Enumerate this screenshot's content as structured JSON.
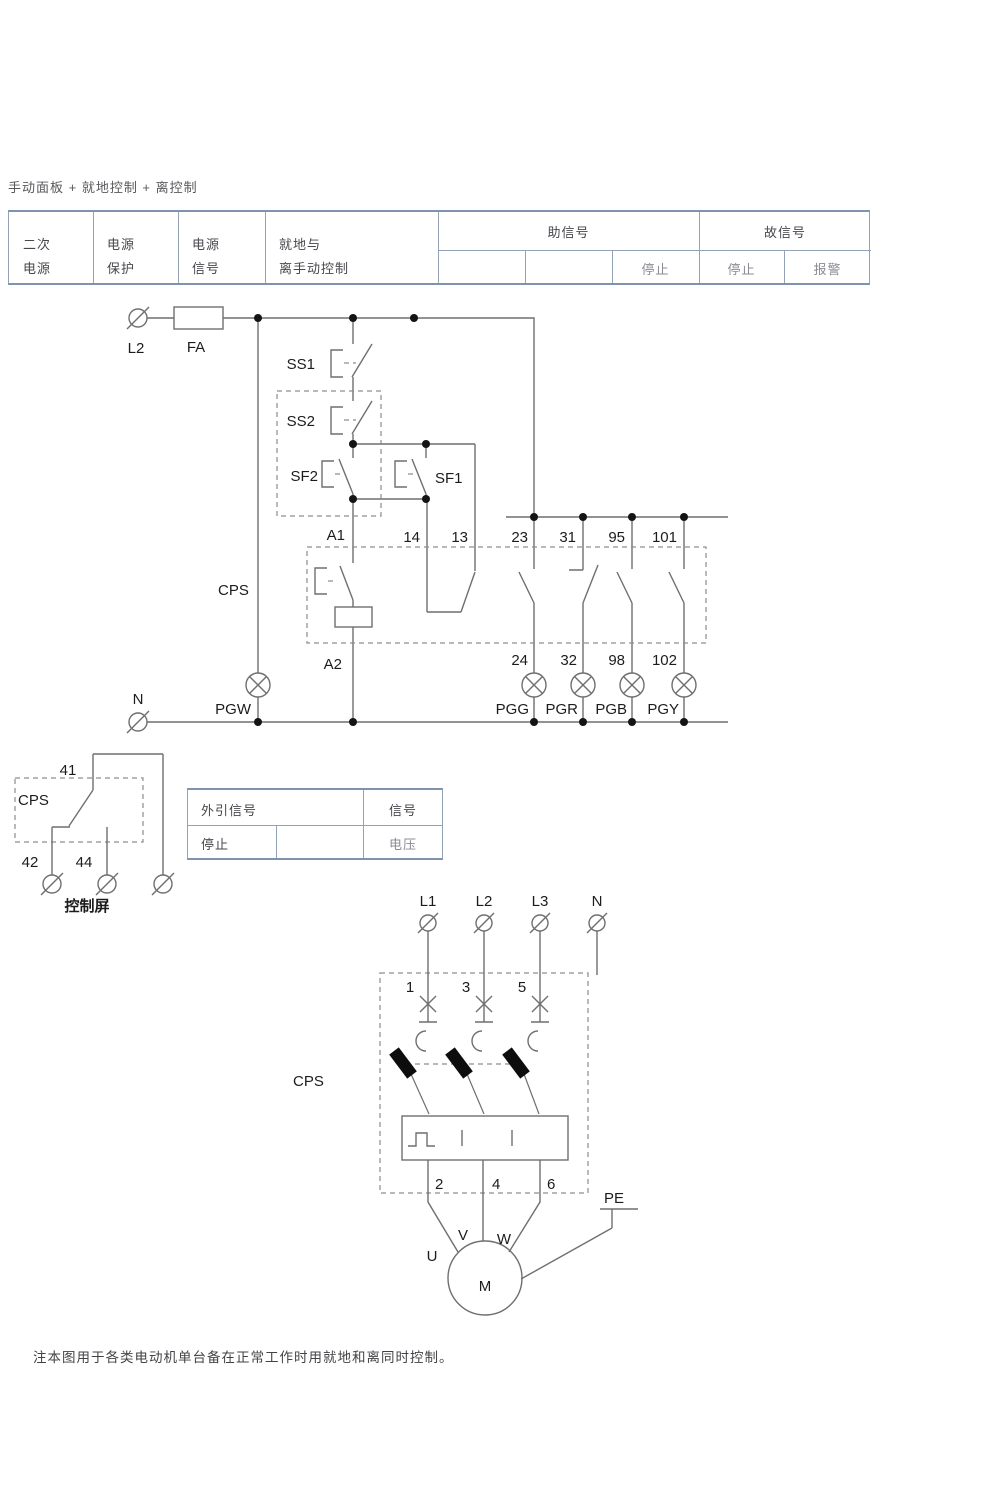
{
  "title": "手动面板 + 就地控制 + 离控制",
  "note": "注本图用于各类电动机单台备在正常工作时用就地和离同时控制。",
  "colors": {
    "wire": "#6f6f6f",
    "dashed": "#8d8d8d",
    "junction_dot": "#141414",
    "table_border": "#8598b1",
    "text_dark": "#1c1c1c",
    "text_gray": "#8b8b95"
  },
  "signal_table": {
    "columns": [
      [
        "二次",
        "电源"
      ],
      [
        "电源",
        "保护"
      ],
      [
        "电源",
        "信号"
      ],
      [
        "就地与",
        "离手动控制"
      ]
    ],
    "groups": [
      {
        "label": "助信号",
        "cells": [
          "",
          "",
          "停止"
        ]
      },
      {
        "label": "故信号",
        "cells": [
          "停止",
          "报警"
        ]
      }
    ]
  },
  "control": {
    "labels": {
      "l2": "L2",
      "fa": "FA",
      "ss1": "SS1",
      "ss2": "SS2",
      "sf2": "SF2",
      "sf1": "SF1",
      "cps": "CPS",
      "a1": "A1",
      "a2": "A2",
      "n": "N",
      "t14": "14",
      "t13": "13",
      "t23": "23",
      "t31": "31",
      "t95": "95",
      "t101": "101",
      "t24": "24",
      "t32": "32",
      "t98": "98",
      "t102": "102",
      "pgw": "PGW",
      "pgg": "PGG",
      "pgr": "PGR",
      "pgb": "PGB",
      "pgy": "PGY"
    }
  },
  "panel": {
    "labels": {
      "t41": "41",
      "cps": "CPS",
      "t42": "42",
      "t44": "44",
      "caption": "控制屏"
    }
  },
  "ref_table": {
    "header": [
      "外引信号",
      "信号"
    ],
    "row": [
      "停止",
      "",
      "电压"
    ]
  },
  "motor": {
    "labels": {
      "l1": "L1",
      "l2": "L2",
      "l3": "L3",
      "n": "N",
      "t1": "1",
      "t3": "3",
      "t5": "5",
      "t2": "2",
      "t4": "4",
      "t6": "6",
      "cps": "CPS",
      "pe": "PE",
      "u": "U",
      "v": "V",
      "w": "W",
      "m": "M"
    }
  }
}
